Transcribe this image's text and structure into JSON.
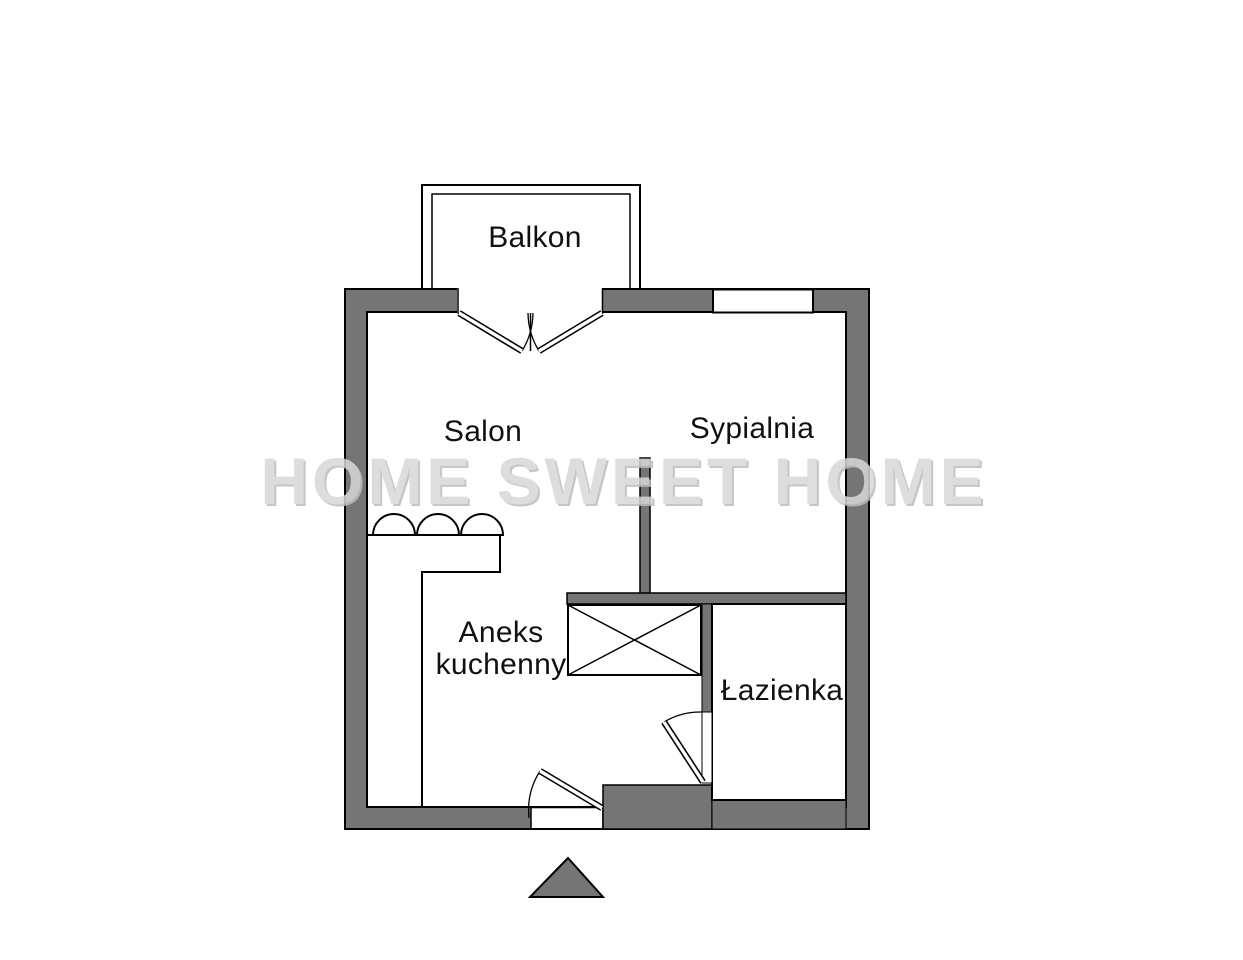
{
  "watermark": {
    "text": "HOME SWEET HOME"
  },
  "rooms": {
    "balkon": {
      "label": "Balkon"
    },
    "salon": {
      "label": "Salon"
    },
    "sypialnia": {
      "label": "Sypialnia"
    },
    "aneks": {
      "line1": "Aneks",
      "line2": "kuchenny"
    },
    "lazienka": {
      "label": "Łazienka"
    }
  },
  "colors": {
    "wall": "#757575",
    "outline": "#000000",
    "floor": "#ffffff",
    "label": "#111111",
    "watermark": "#d8d8d8",
    "watermarkShadow": "#bdbdbd"
  }
}
